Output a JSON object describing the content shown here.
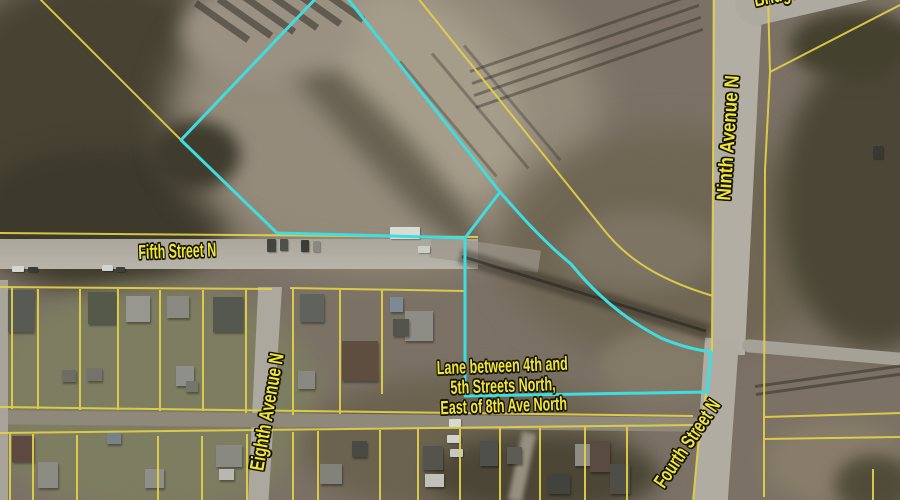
{
  "map": {
    "street_labels": [
      {
        "id": "fifth-street",
        "text": "Fifth Street N"
      },
      {
        "id": "ninth-avenue",
        "text": "Ninth Avenue N"
      },
      {
        "id": "eighth-avenue",
        "text": "Eighth Avenue N"
      },
      {
        "id": "fourth-street",
        "text": "Fourth Street N"
      },
      {
        "id": "bridge",
        "text": "Bridge"
      }
    ],
    "annotation": {
      "line1": "Lane between 4th and",
      "line2": "5th Streets North,",
      "line3": "East of 8th Ave North"
    },
    "colors": {
      "parcel_line": "#e4d148",
      "highlight_outline": "#3fdde0",
      "label_text": "#f2e53a"
    }
  },
  "scene": {
    "houses": [
      {
        "x": 8,
        "y": 290,
        "w": 26,
        "h": 42,
        "c": "#585b54"
      },
      {
        "x": 88,
        "y": 292,
        "w": 28,
        "h": 32,
        "c": "#545949"
      },
      {
        "x": 126,
        "y": 296,
        "w": 24,
        "h": 26,
        "c": "#97978f"
      },
      {
        "x": 167,
        "y": 296,
        "w": 22,
        "h": 22,
        "c": "#8a8a82"
      },
      {
        "x": 213,
        "y": 297,
        "w": 30,
        "h": 35,
        "c": "#55584f"
      },
      {
        "x": 62,
        "y": 370,
        "w": 14,
        "h": 12,
        "c": "#6d6d63"
      },
      {
        "x": 87,
        "y": 368,
        "w": 15,
        "h": 13,
        "c": "#737369"
      },
      {
        "x": 176,
        "y": 366,
        "w": 18,
        "h": 20,
        "c": "#8f8f89"
      },
      {
        "x": 186,
        "y": 381,
        "w": 12,
        "h": 11,
        "c": "#75756b"
      },
      {
        "x": 300,
        "y": 294,
        "w": 24,
        "h": 28,
        "c": "#60635c"
      },
      {
        "x": 390,
        "y": 297,
        "w": 13,
        "h": 15,
        "c": "#7d8994"
      },
      {
        "x": 405,
        "y": 311,
        "w": 28,
        "h": 30,
        "c": "#8d8d85"
      },
      {
        "x": 393,
        "y": 319,
        "w": 16,
        "h": 17,
        "c": "#53554d"
      },
      {
        "x": 342,
        "y": 341,
        "w": 36,
        "h": 40,
        "c": "#5d4e40"
      },
      {
        "x": 298,
        "y": 371,
        "w": 17,
        "h": 18,
        "c": "#898981"
      },
      {
        "x": 12,
        "y": 436,
        "w": 22,
        "h": 26,
        "c": "#5e4940"
      },
      {
        "x": 38,
        "y": 462,
        "w": 20,
        "h": 26,
        "c": "#8c8c84"
      },
      {
        "x": 107,
        "y": 432,
        "w": 14,
        "h": 12,
        "c": "#7b818b"
      },
      {
        "x": 145,
        "y": 469,
        "w": 19,
        "h": 19,
        "c": "#8f8f89"
      },
      {
        "x": 216,
        "y": 445,
        "w": 26,
        "h": 22,
        "c": "#898981"
      },
      {
        "x": 219,
        "y": 469,
        "w": 15,
        "h": 11,
        "c": "#b8b8b0"
      },
      {
        "x": 320,
        "y": 464,
        "w": 22,
        "h": 20,
        "c": "#82827a"
      },
      {
        "x": 352,
        "y": 441,
        "w": 15,
        "h": 16,
        "c": "#4a4a44"
      },
      {
        "x": 423,
        "y": 446,
        "w": 20,
        "h": 24,
        "c": "#54544c"
      },
      {
        "x": 425,
        "y": 474,
        "w": 19,
        "h": 13,
        "c": "#c1c1b9"
      },
      {
        "x": 480,
        "y": 441,
        "w": 18,
        "h": 25,
        "c": "#50504a"
      },
      {
        "x": 507,
        "y": 447,
        "w": 15,
        "h": 17,
        "c": "#5c5c54"
      },
      {
        "x": 548,
        "y": 474,
        "w": 22,
        "h": 20,
        "c": "#43433d"
      },
      {
        "x": 575,
        "y": 444,
        "w": 28,
        "h": 22,
        "c": "#8d8d85"
      },
      {
        "x": 590,
        "y": 441,
        "w": 20,
        "h": 31,
        "c": "#594b41"
      },
      {
        "x": 610,
        "y": 464,
        "w": 20,
        "h": 30,
        "c": "#4e4e46"
      }
    ],
    "cars": [
      {
        "x": 12,
        "y": 266,
        "w": 12,
        "h": 6,
        "c": "#d7d7d1"
      },
      {
        "x": 28,
        "y": 267,
        "w": 10,
        "h": 5,
        "c": "#3b3b35"
      },
      {
        "x": 102,
        "y": 265,
        "w": 11,
        "h": 6,
        "c": "#d4d4ce"
      },
      {
        "x": 116,
        "y": 267,
        "w": 9,
        "h": 5,
        "c": "#403f39"
      },
      {
        "x": 267,
        "y": 239,
        "w": 9,
        "h": 13,
        "c": "#44443e"
      },
      {
        "x": 280,
        "y": 239,
        "w": 8,
        "h": 12,
        "c": "#50504a"
      },
      {
        "x": 301,
        "y": 240,
        "w": 8,
        "h": 12,
        "c": "#3d3d37"
      },
      {
        "x": 313,
        "y": 241,
        "w": 7,
        "h": 11,
        "c": "#89897f"
      },
      {
        "x": 390,
        "y": 227,
        "w": 30,
        "h": 12,
        "c": "#dbdbd5"
      },
      {
        "x": 418,
        "y": 246,
        "w": 12,
        "h": 7,
        "c": "#cecec8"
      },
      {
        "x": 873,
        "y": 146,
        "w": 10,
        "h": 13,
        "c": "#393933"
      },
      {
        "x": 449,
        "y": 419,
        "w": 12,
        "h": 8,
        "c": "#d9d9d3"
      },
      {
        "x": 447,
        "y": 435,
        "w": 14,
        "h": 8,
        "c": "#d2d2cc"
      },
      {
        "x": 450,
        "y": 449,
        "w": 13,
        "h": 8,
        "c": "#c8c8c2"
      }
    ]
  }
}
